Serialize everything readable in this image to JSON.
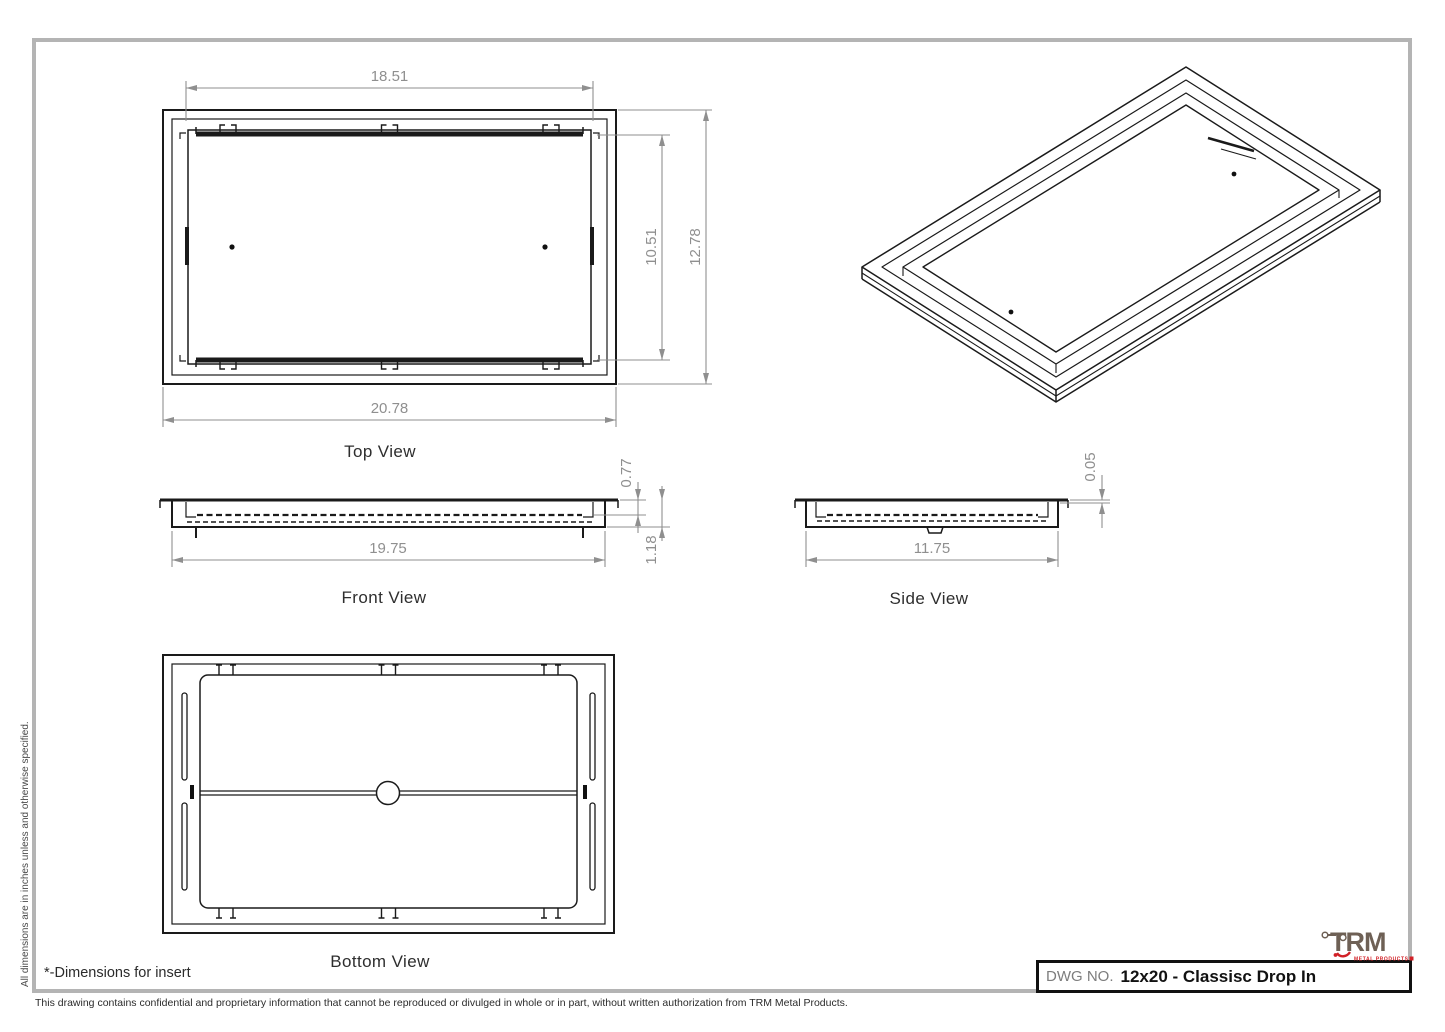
{
  "sheet": {
    "units_note": "All dimensions are in inches unless and otherwise specified.",
    "insert_note": "*-Dimensions for insert",
    "footer_note": "This drawing contains confidential and proprietary information that cannot be reproduced or divulged in whole or in part, without written authorization from TRM Metal Products."
  },
  "title_block": {
    "dwg_no_label": "DWG NO.",
    "dwg_no_value": "12x20 - Classisc Drop In"
  },
  "logo": {
    "name": "TRM",
    "tagline": "METAL PRODUCTS",
    "letter_color": "#6e6055",
    "accent_color": "#d12026"
  },
  "views": {
    "top": {
      "label": "Top View",
      "dims": {
        "inner_width": "18.51",
        "inner_height": "10.51",
        "outer_height": "12.78",
        "outer_width": "20.78"
      }
    },
    "front": {
      "label": "Front View",
      "dims": {
        "insert_depth": "0.77",
        "overall_depth": "1.18",
        "width": "19.75"
      }
    },
    "side": {
      "label": "Side View",
      "dims": {
        "flange_height": "0.05",
        "width": "11.75"
      }
    },
    "bottom": {
      "label": "Bottom View"
    }
  }
}
